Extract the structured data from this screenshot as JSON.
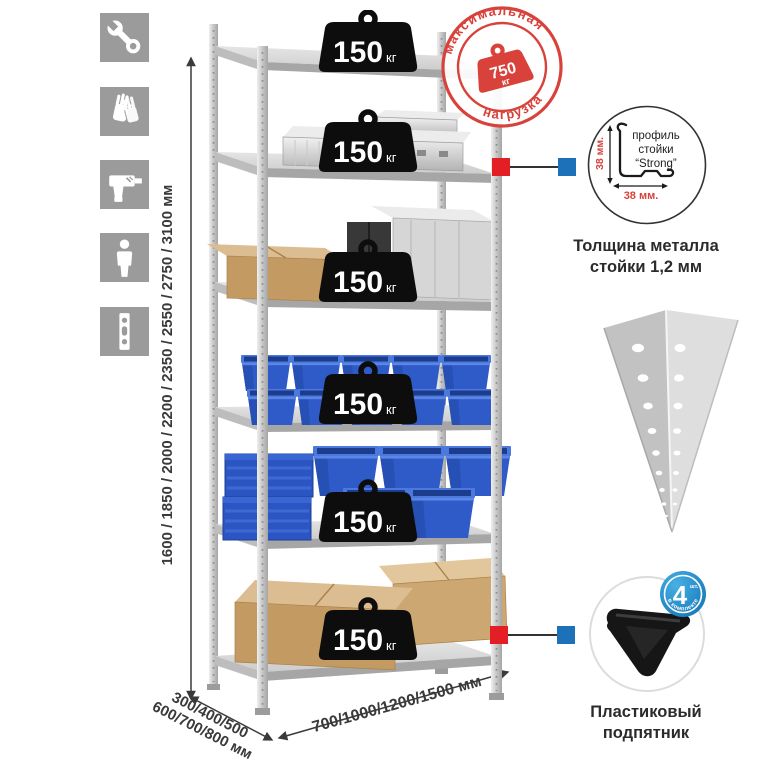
{
  "sidebar": {
    "icons": [
      {
        "name": "wrench"
      },
      {
        "name": "gloves"
      },
      {
        "name": "drill"
      },
      {
        "name": "assembler-person"
      },
      {
        "name": "perforated-profile"
      }
    ]
  },
  "dimensions": {
    "height": "1600 / 1850 / 2000 / 2200 / 2350 / 2550 / 2750 / 3100 мм",
    "depth_line1": "300/400/500",
    "depth_line2": "600/700/800 мм",
    "width": "700/1000/1200/1500 мм"
  },
  "weights": {
    "value": "150",
    "unit": "кг",
    "count": 6
  },
  "stamp": {
    "arc_top": "максимальная",
    "arc_bottom": "нагрузка",
    "value": "750",
    "unit": "кг"
  },
  "profile_detail": {
    "line1": "профиль",
    "line2": "стойки",
    "line3": "“Strong”",
    "dim_vertical": "38 мм.",
    "dim_horizontal": "38 мм.",
    "caption_line1": "Толщина металла",
    "caption_line2": "стойки 1,2 мм"
  },
  "foot_detail": {
    "badge_number": "4",
    "badge_unit": "шт.",
    "badge_arc": "в комплекте",
    "caption_line1": "Пластиковый",
    "caption_line2": "подпятник"
  },
  "colors": {
    "stamp-red": "#d8423b",
    "connector-red": "#e31e24",
    "connector-blue": "#1d71b8",
    "badge-blue": "#1f8ccc",
    "bin-blue": "#2e5bc8",
    "tile-gray": "#9b9b9b",
    "metal-light": "#dadada",
    "metal-mid": "#a6a6a6",
    "cardboard": "#c49a63",
    "text-dark": "#333333"
  }
}
